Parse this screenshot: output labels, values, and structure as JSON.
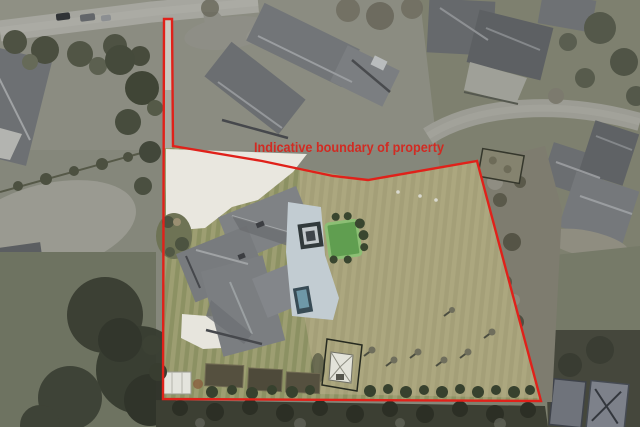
{
  "annotation": {
    "label": "Indicative boundary of property",
    "color": "#d8231b",
    "line_color": "#e0211a"
  },
  "scene": {
    "type": "aerial-photograph",
    "subject": "residential property with house, lawn and outbuildings",
    "features": {
      "boundary": "red indicative boundary outline with narrow access strip to road",
      "main_house": "gray hip-roof house",
      "driveway": "white concrete driveway",
      "putting_green": "small synthetic green",
      "greenhouse": "small glasshouse in lawn",
      "hedge": "dark hedgerow along bottom boundary"
    }
  }
}
